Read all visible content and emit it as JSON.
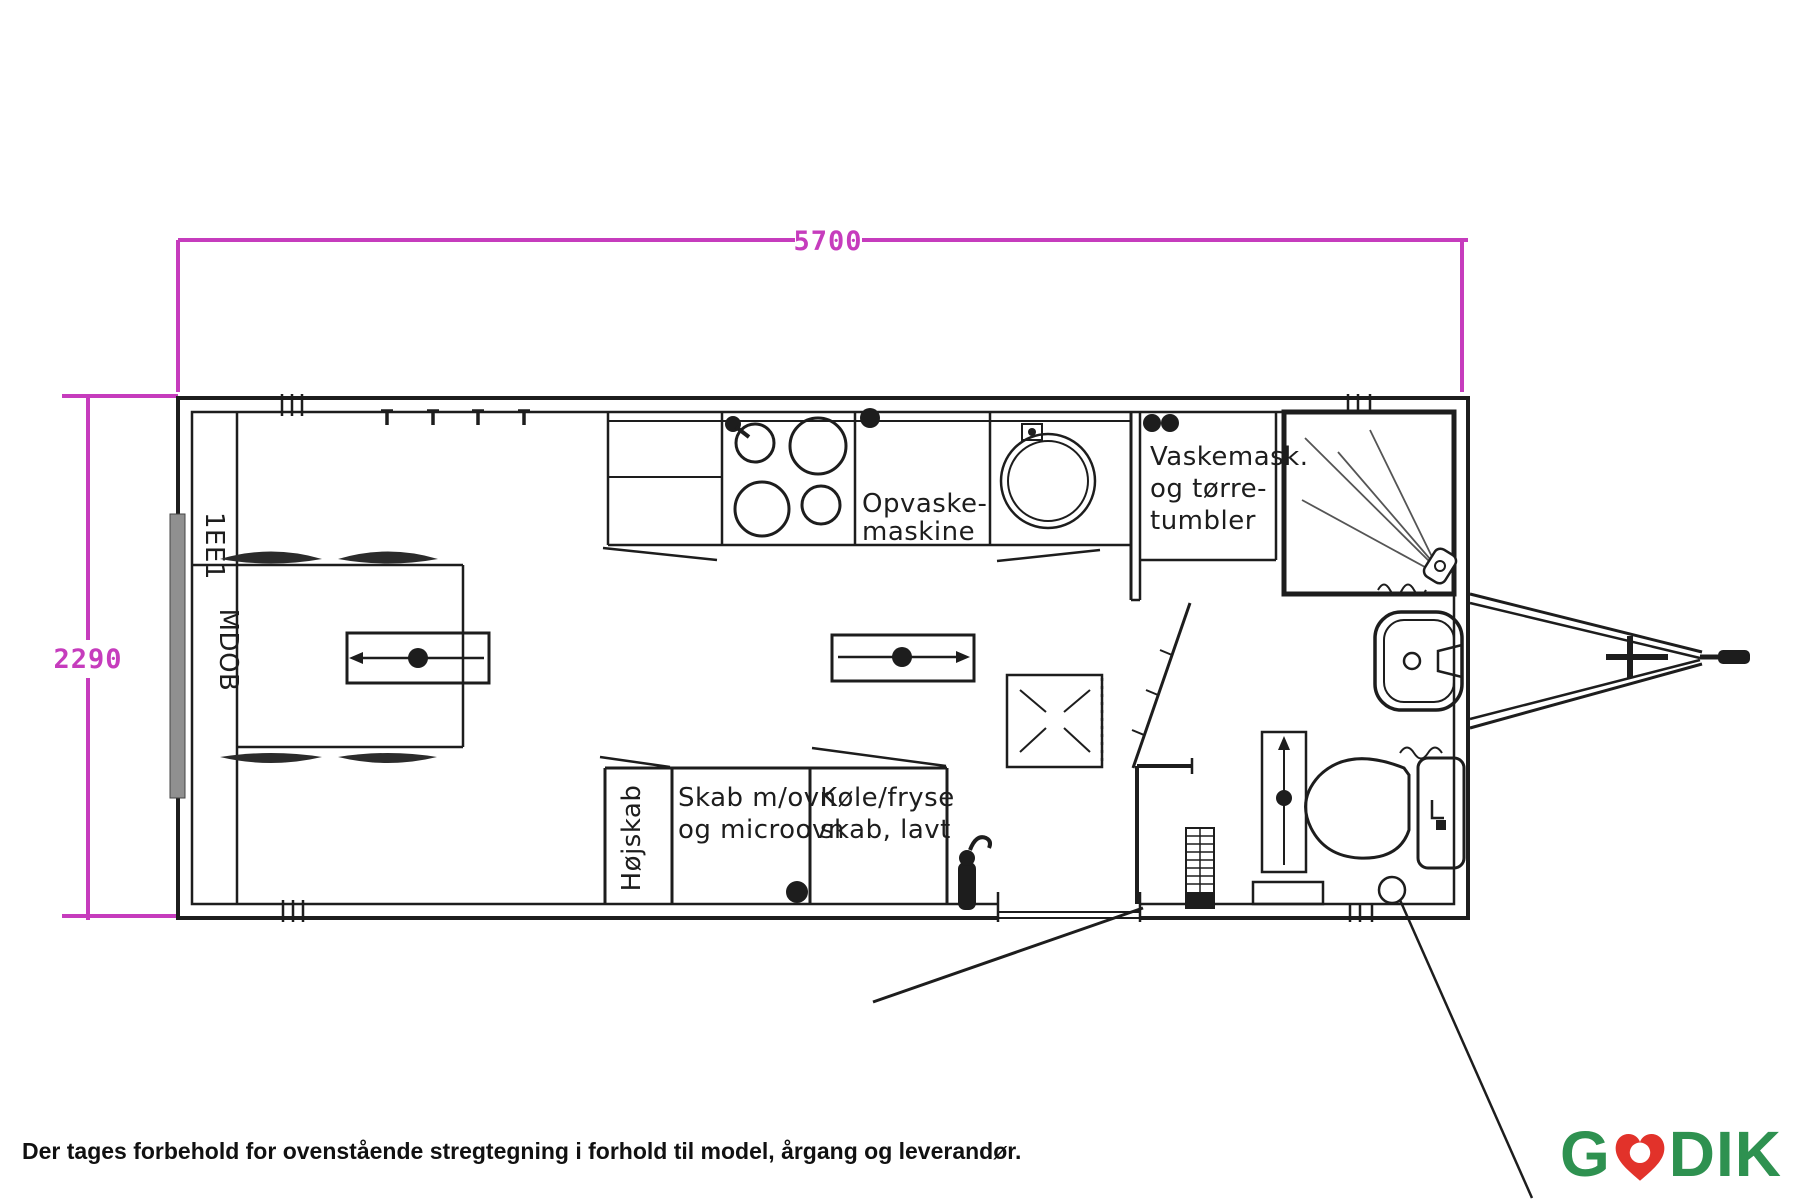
{
  "colors": {
    "dimension_pink": "#c63cbd",
    "line_black": "#1d1d1d",
    "window_gray": "#909090",
    "logo_green": "#2e9150",
    "logo_red": "#e2322a"
  },
  "dimensions": {
    "top_width": "5700",
    "left_height": "2290"
  },
  "plan": {
    "dishwasher_line1": "Opvaske-",
    "dishwasher_line2": "maskine",
    "washer_line1": "Vaskemask.",
    "washer_line2": "og tørre-",
    "washer_line3": "tumbler",
    "tall_cabinet": "Højskab",
    "oven_cabinet_line1": "Skab m/ovn",
    "oven_cabinet_line2": "og microovn",
    "fridge_line1": "Køle/fryse",
    "fridge_line2": "skab, lavt",
    "bed_side_text": "MDOB",
    "window_note": "1EE1"
  },
  "footer": {
    "disclaimer": "Der tages forbehold for ovenstående stregtegning i forhold til model, årgang og leverandør."
  },
  "logo": {
    "prefix": "G",
    "suffix": "DIK"
  }
}
